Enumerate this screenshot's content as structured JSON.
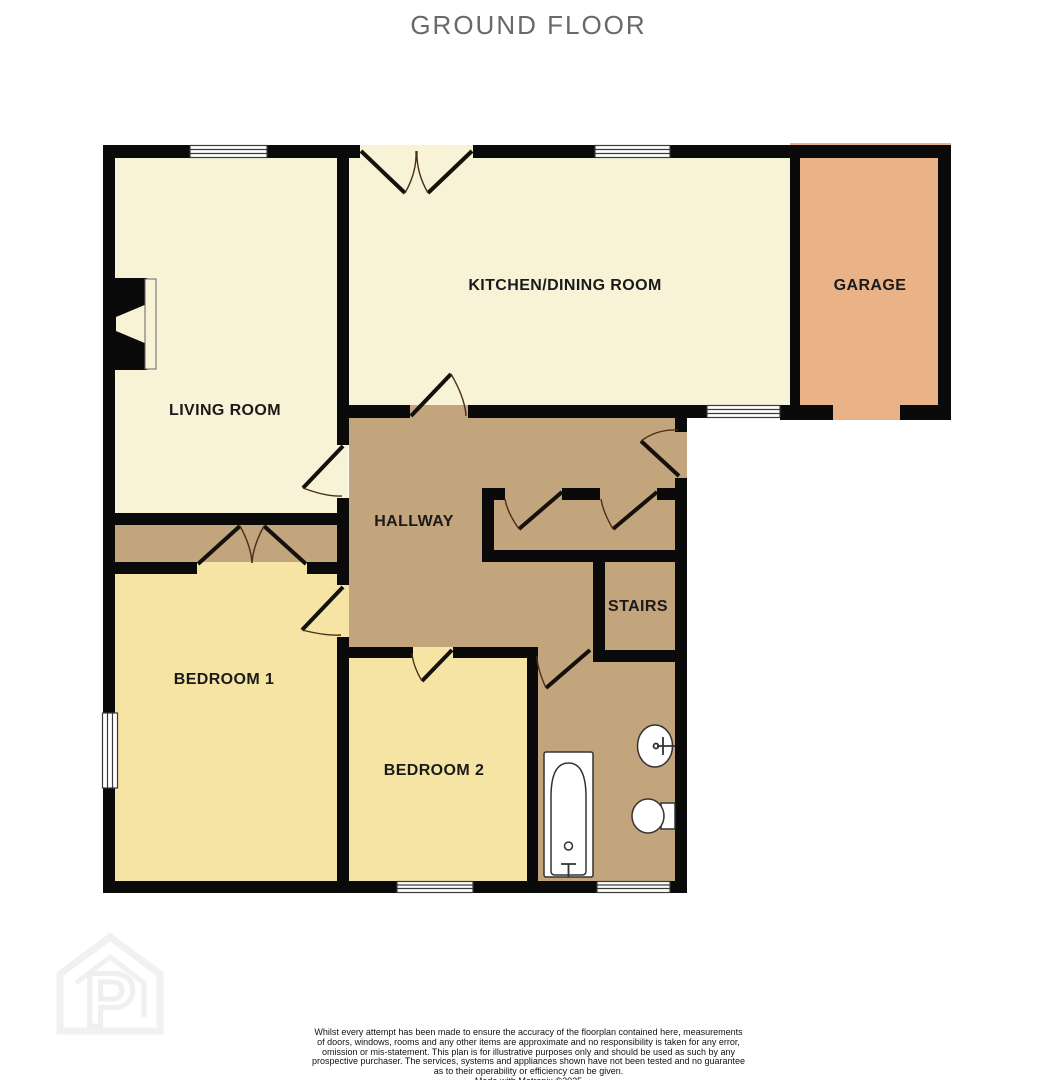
{
  "title": "GROUND FLOOR",
  "rooms": {
    "living": {
      "label": "LIVING ROOM"
    },
    "kitchen": {
      "label": "KITCHEN/DINING ROOM"
    },
    "garage": {
      "label": "GARAGE"
    },
    "hallway": {
      "label": "HALLWAY"
    },
    "stairs": {
      "label": "STAIRS"
    },
    "bedroom1": {
      "label": "BEDROOM 1"
    },
    "bedroom2": {
      "label": "BEDROOM 2"
    }
  },
  "colors": {
    "cream": "#f8f2d7",
    "tan": "#c2a47d",
    "yellow": "#f5e4a4",
    "garage_orange": "#eab387",
    "wall": "#0a0a0a",
    "title_gray": "#696969"
  },
  "watermark_letter": "P",
  "footer": {
    "lines": [
      "Whilst every attempt has been made to ensure the accuracy of the floorplan contained here, measurements",
      "of doors, windows, rooms and any other items are approximate and no responsibility is taken for any error,",
      "omission or mis-statement. This plan is for illustrative purposes only and should be used as such by any",
      "prospective purchaser. The services, systems and appliances shown have not been tested and no guarantee",
      "as to their operability or efficiency can be given.",
      "Made with Metropix ©2025"
    ]
  }
}
